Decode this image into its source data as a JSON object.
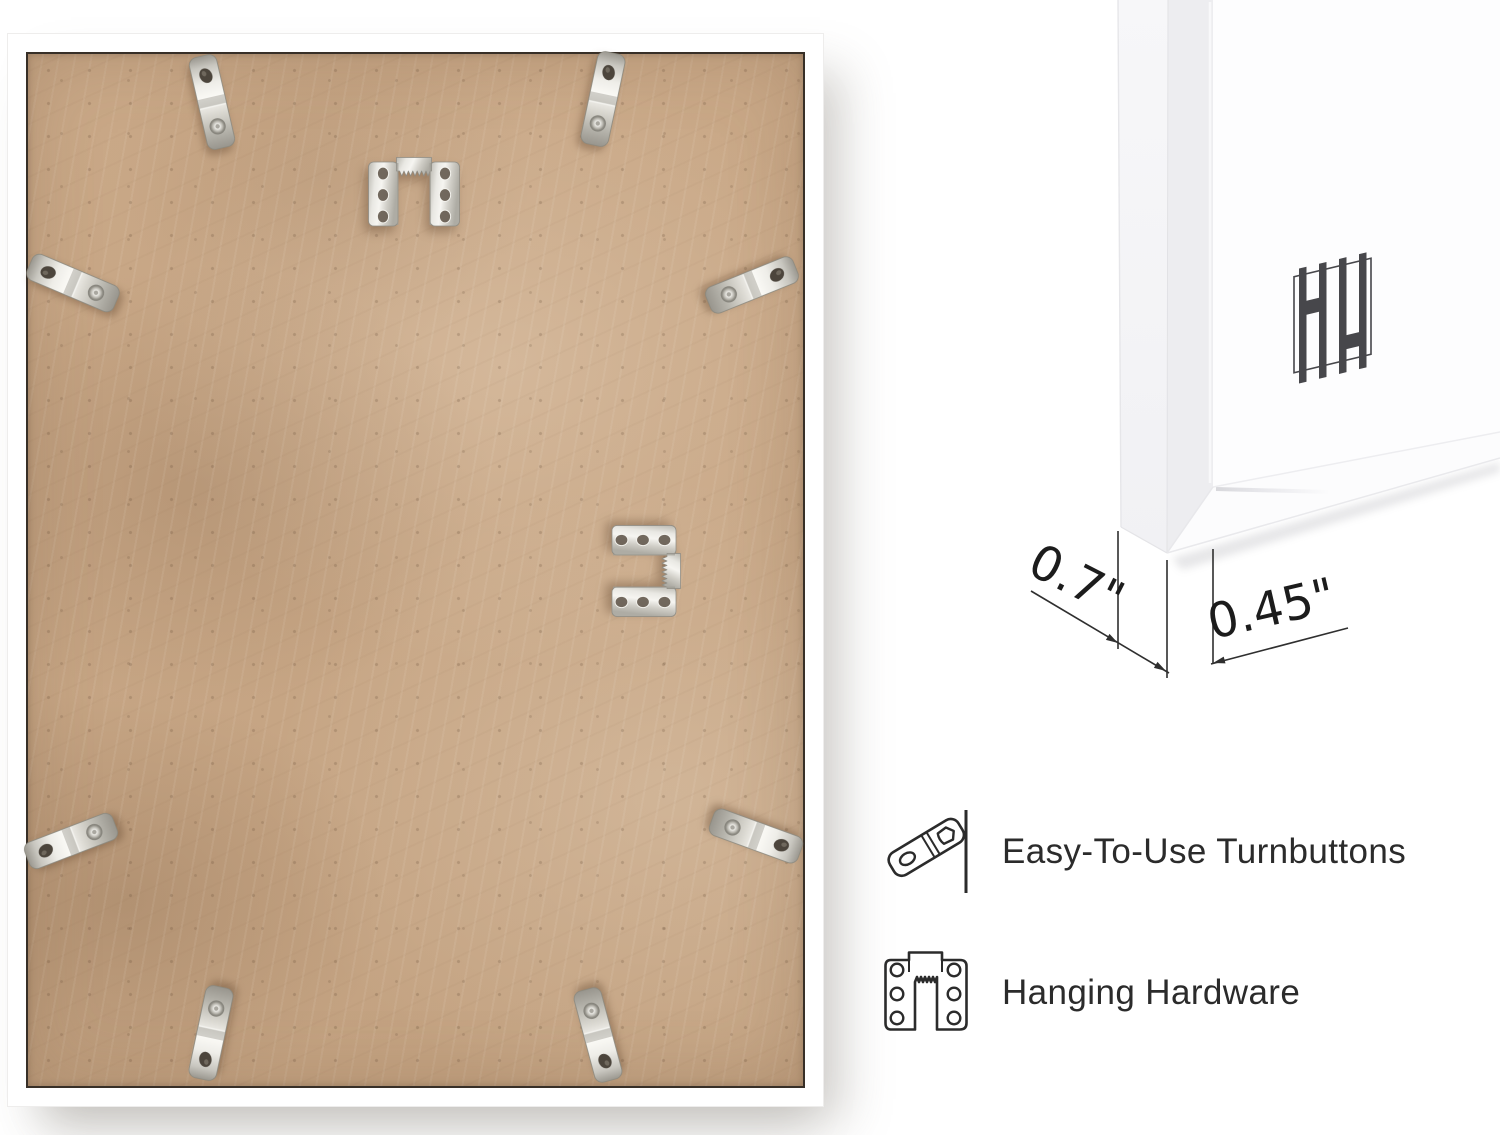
{
  "scene": {
    "type": "product-infographic",
    "background_color": "#ffffff"
  },
  "frame_back_photo": {
    "description": "back of white picture frame with MDF backing board",
    "frame_color": "#ffffff",
    "backing_color": "#c7a685",
    "inner_outline_color": "#372f27",
    "metal_color": "#d8d6cf",
    "turnbutton_count": 8,
    "sawtooth_hanger_count": 2
  },
  "corner_render": {
    "description": "3D corner view of white frame profile",
    "frame_face_color": "#ededf0",
    "frame_side_color": "#f6f6f8",
    "mat_color": "#fdfdfe",
    "brand_mark": "HH",
    "brand_mark_color": "#47474b",
    "dimension_line_color": "#2f2f2f",
    "dimensions": {
      "depth": "0.7\"",
      "face_width": "0.45\""
    }
  },
  "features": {
    "text_color": "#2b2b2b",
    "items": [
      {
        "icon": "turnbutton-outline-icon",
        "label": "Easy-To-Use Turnbuttons"
      },
      {
        "icon": "hanging-hardware-outline-icon",
        "label": "Hanging Hardware"
      }
    ]
  }
}
